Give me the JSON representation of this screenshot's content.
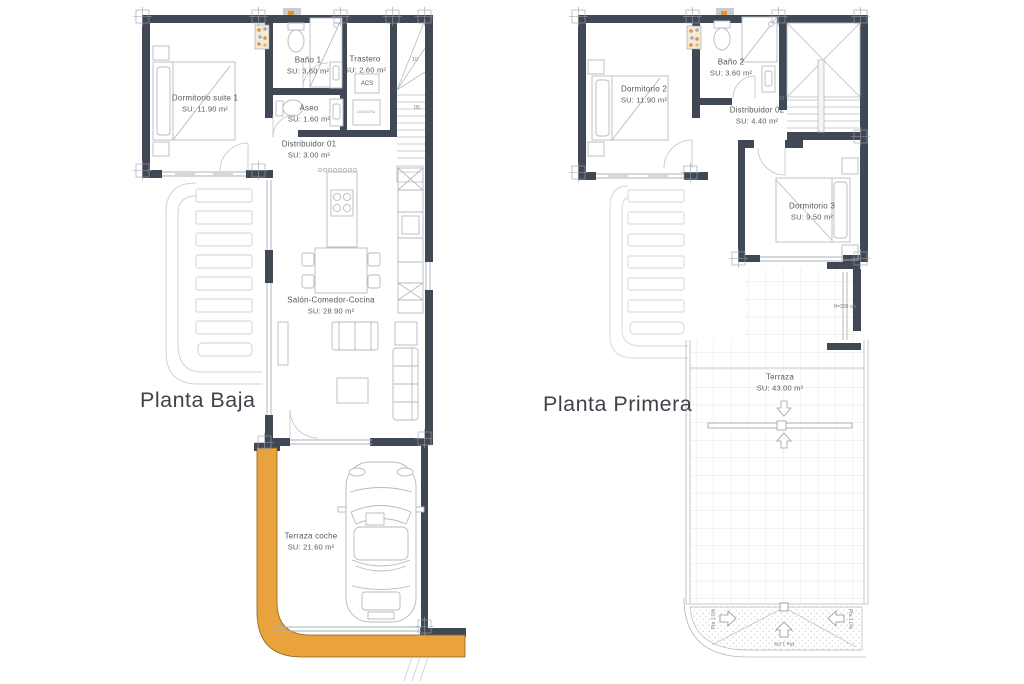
{
  "colors": {
    "wall": "#414855",
    "accent_orange": "#E9A23C",
    "orange_border": "#8a621c",
    "furniture_line": "#b6bbc2",
    "tile_grid": "#dcdee2",
    "label_text": "#53575d",
    "title_text": "#3f444b"
  },
  "plans": {
    "left": {
      "title": "Planta Baja",
      "rooms": {
        "dormitorio_suite_1": {
          "name": "Dormitorio suite 1",
          "area": "SU: 11.90 m²"
        },
        "bano_1": {
          "name": "Baño 1",
          "area": "SU: 3.60 m²"
        },
        "trastero": {
          "name": "Trastero",
          "area": "SU: 2.60 m²"
        },
        "aseo": {
          "name": "Aseo",
          "area": "SU: 1.60 m²"
        },
        "distribuidor_01": {
          "name": "Distribuidor 01",
          "area": "SU: 3.00 m²"
        },
        "salon_comedor_cocina": {
          "name": "Salón-Comedor-Cocina",
          "area": "SU: 28.90 m²"
        },
        "terraza_coche": {
          "name": "Terraza coche",
          "area": "SU: 21.60 m²"
        }
      },
      "annotations": {
        "acs": "ACS",
        "lavadora": "LAVADORA",
        "stair_step_10": "10",
        "stair_step_05": "05"
      }
    },
    "right": {
      "title": "Planta Primera",
      "rooms": {
        "dormitorio_2": {
          "name": "Dormitorio 2",
          "area": "SU: 11.90 m²"
        },
        "bano_2": {
          "name": "Baño 2",
          "area": "SU: 3.60 m²"
        },
        "distribuidor_02": {
          "name": "Distribuidor 02",
          "area": "SU: 4.40 m²"
        },
        "dormitorio_3": {
          "name": "Dormitorio 3",
          "area": "SU: 9.50 m²"
        },
        "terraza": {
          "name": "Terraza",
          "area": "SU: 43.00 m²"
        }
      },
      "annotations": {
        "height_note": "H=230 cm",
        "slope_left": "Pte 1.0%",
        "slope_center": "Pte 1.0%",
        "slope_right": "Pte 1.0%",
        "stair_step_01": "01"
      }
    }
  }
}
